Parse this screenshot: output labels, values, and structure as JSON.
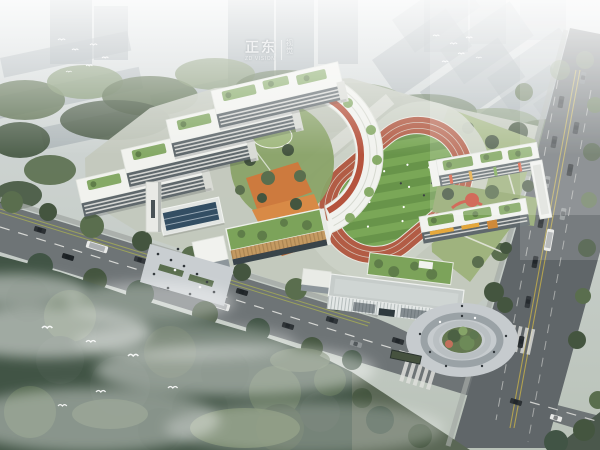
{
  "watermark": {
    "brand": "正东",
    "brand_sub": "ZD VISION",
    "seal_top": "视",
    "seal_bottom": "觉"
  },
  "scene": {
    "type": "aerial-architectural-rendering",
    "subject": "School campus master-plan bird's-eye rendering",
    "setting": "hazy city blocks behind, tree-lined arterial road in front, side road at right, misty woodland in foreground",
    "elements": [
      "city tower blocks in haze",
      "rows of low slab buildings",
      "teaching building slabs with green roofs",
      "curved link building",
      "landscaped courtyard with orange terraces",
      "running track with striped field",
      "grandstand",
      "kindergarten cluster with play yard",
      "gymnasium with timber louvres and green roof",
      "entrance canopy with skylight",
      "campus tower",
      "entry plaza with pedestrians",
      "lattice-facade building with roof garden",
      "circular paved plaza with tree island",
      "bus shelter",
      "main diagonal road with cars and buses",
      "side road with double yellow line",
      "zebra crosswalks",
      "street trees",
      "dense forest with mist",
      "white birds"
    ]
  },
  "colors": {
    "sky_top": "#d7dcde",
    "sky_bottom": "#b9c2b8",
    "city_block": "#9aa4a9",
    "building_white": "#f1f2ee",
    "facade_dark": "#5f686c",
    "roof_green": "#7ca35a",
    "track_red": "#b25c45",
    "field_green_light": "#7aa757",
    "field_green_dark": "#68944a",
    "lawn": "#9fb37e",
    "courtyard_orange": "#cd7a3e",
    "accent_red": "#b14a33",
    "awning_yellow": "#e5a83c",
    "wood": "#c49a62",
    "glass_blue": "#334e63",
    "water_blue": "#8fb4c9",
    "road": "#6e7476",
    "road_dark": "#606669",
    "paving": "#c9ced1",
    "marking_white": "#e9e9e5",
    "marking_yellow": "#c6b04a",
    "tree_dark": "#44553f",
    "tree_mid": "#5a6e4e",
    "tree_light": "#7a8f68",
    "forest_dark": "#415445",
    "mist_white": "#ffffff"
  }
}
